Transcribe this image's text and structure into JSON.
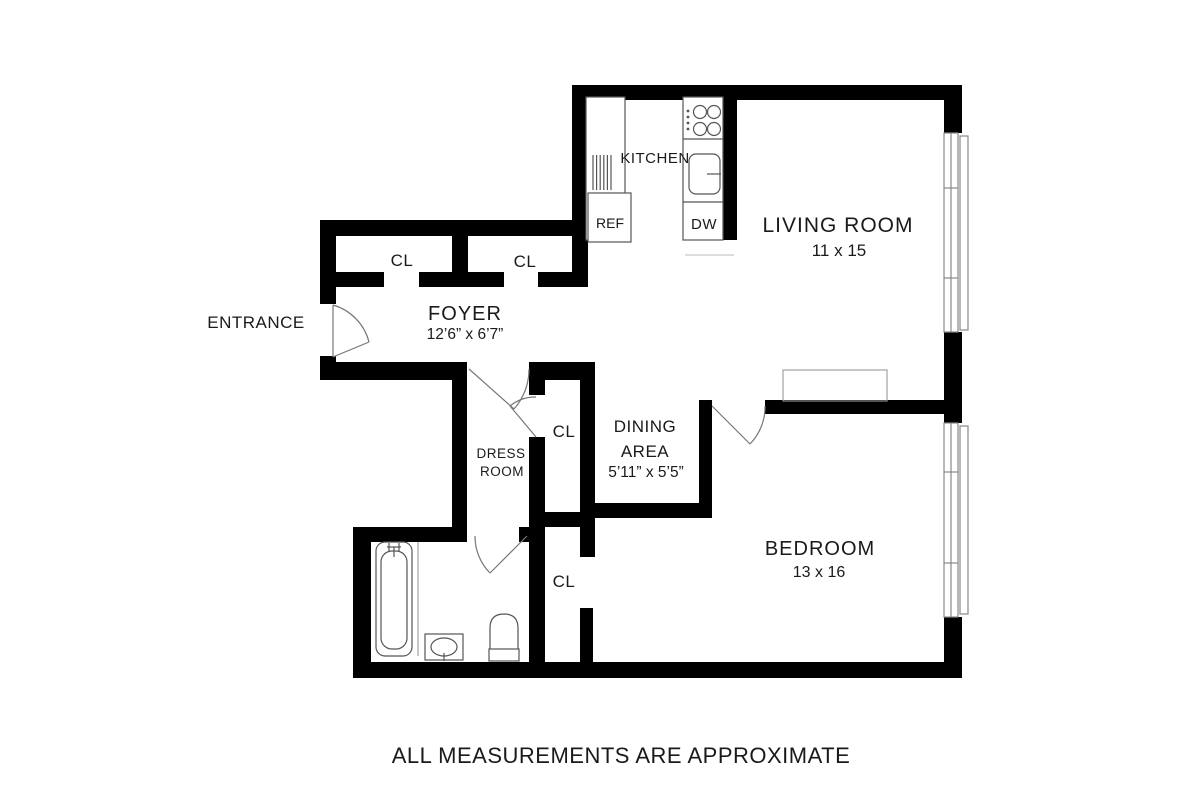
{
  "footnote": "ALL MEASUREMENTS ARE APPROXIMATE",
  "rooms": {
    "living": {
      "name": "LIVING ROOM",
      "dims": "11 x 15"
    },
    "bedroom": {
      "name": "BEDROOM",
      "dims": "13 x 16"
    },
    "foyer": {
      "name": "FOYER",
      "dims": "12’6” x 6’7”"
    },
    "dining": {
      "line1": "DINING",
      "line2": "AREA",
      "dims": "5’11” x 5’5”"
    },
    "dress": {
      "line1": "DRESS",
      "line2": "ROOM"
    },
    "kitchen": {
      "name": "KITCHEN"
    },
    "entrance": {
      "name": "ENTRANCE"
    }
  },
  "closets": {
    "upper_left": "CL",
    "upper_right": "CL",
    "hall": "CL",
    "bedroom": "CL"
  },
  "appliances": {
    "ref": "REF",
    "dw": "DW"
  },
  "colors": {
    "wall": "#000000",
    "fixture": "#555555",
    "window": "#888888",
    "door": "#777777",
    "text": "#1a1a1a"
  }
}
